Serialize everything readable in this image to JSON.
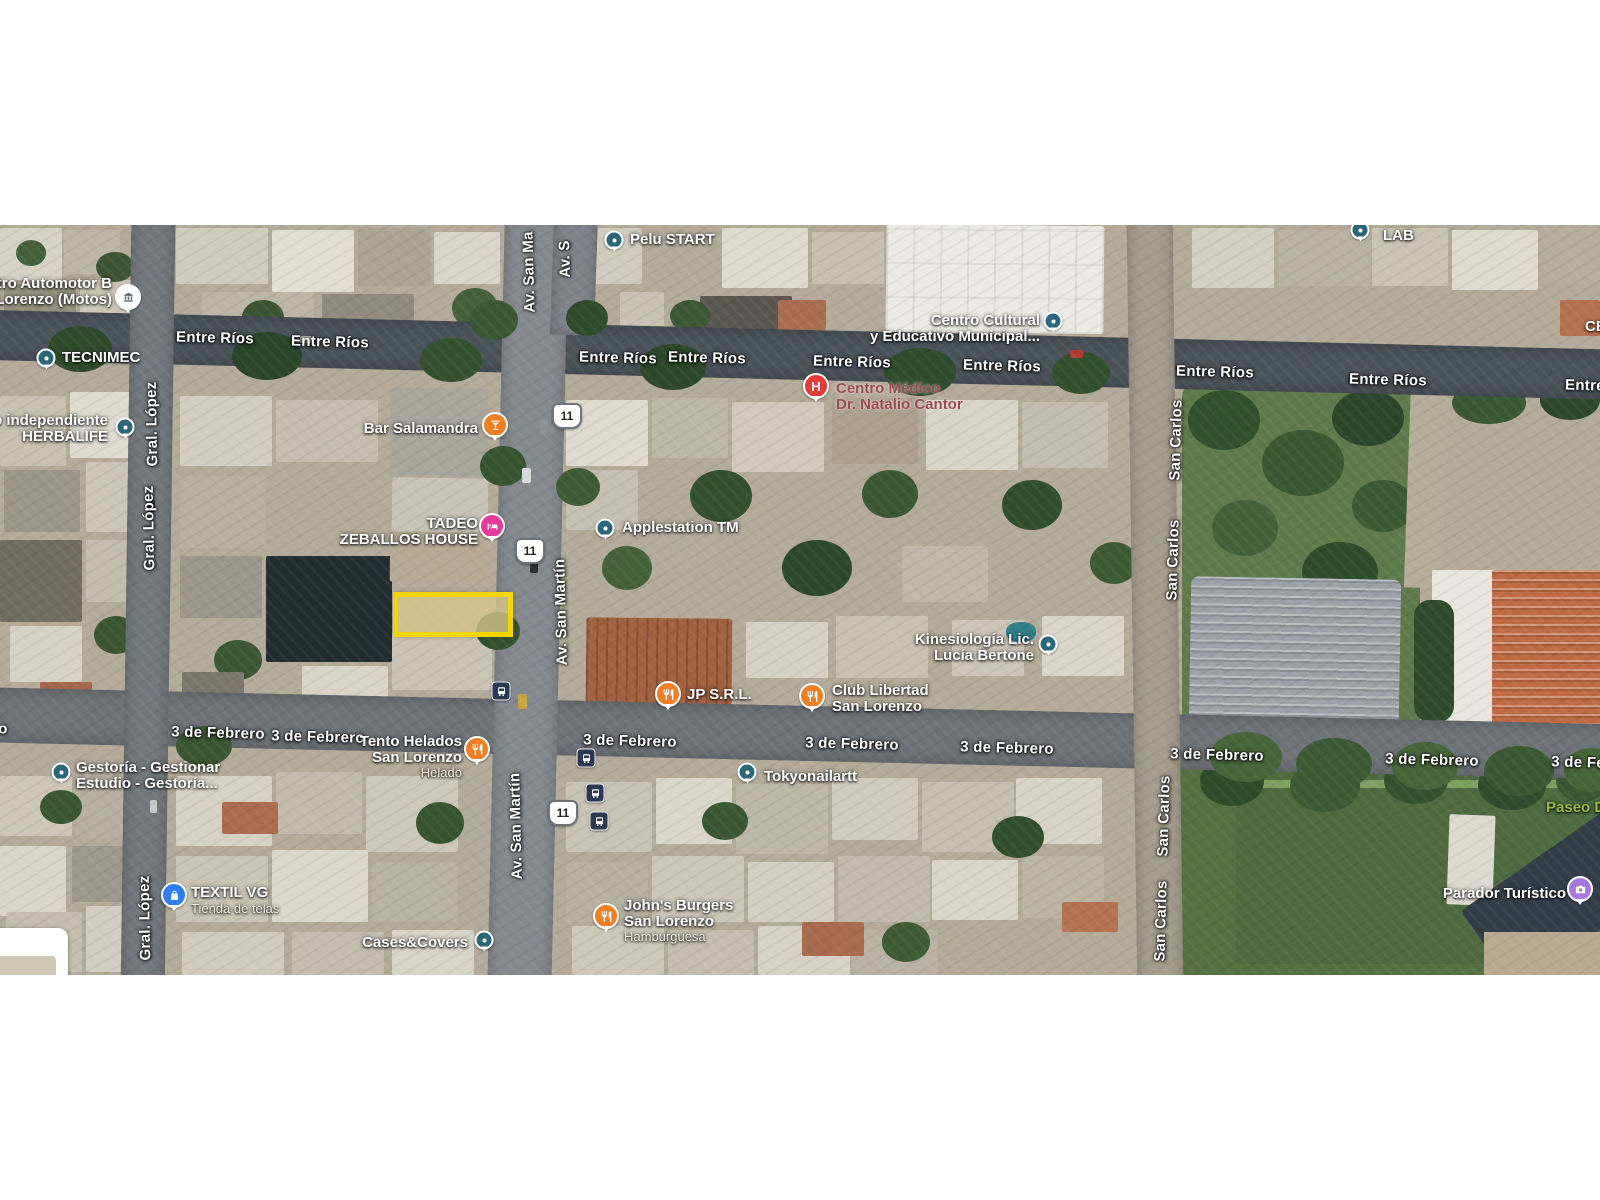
{
  "map": {
    "highlight": {
      "x": 393,
      "y": 592,
      "w": 110,
      "h": 35,
      "border_color": "#F6D400",
      "fill_color": "rgba(216,198,140,0.78)"
    },
    "colors": {
      "generic_marker": "#2A6879",
      "restaurant_marker": "#F07E22",
      "lodging_marker": "#E5399B",
      "hospital_marker": "#E53935",
      "shopping_marker": "#2F7DF6",
      "photo_marker": "#A678DD",
      "transit_bg": "#2B3A52",
      "health_text": "#9B4A50",
      "park_text": "#9DB64C",
      "highlight": "#F6D400"
    },
    "street_labels": [
      {
        "text": "Entre Ríos",
        "x": 215,
        "y": 338,
        "rot": 1.5
      },
      {
        "text": "Entre Ríos",
        "x": 330,
        "y": 342,
        "rot": 1.5
      },
      {
        "text": "Entre Ríos",
        "x": 618,
        "y": 358,
        "rot": 1.5
      },
      {
        "text": "Entre Ríos",
        "x": 707,
        "y": 358,
        "rot": 1.5
      },
      {
        "text": "Entre Ríos",
        "x": 852,
        "y": 362,
        "rot": 1.5
      },
      {
        "text": "Entre Ríos",
        "x": 1002,
        "y": 366,
        "rot": 1.5
      },
      {
        "text": "Entre Ríos",
        "x": 1215,
        "y": 372,
        "rot": 1.5
      },
      {
        "text": "Entre Ríos",
        "x": 1388,
        "y": 380,
        "rot": 1.5
      },
      {
        "text": "Entre Ríos",
        "x": 1604,
        "y": 386,
        "rot": 1.5
      },
      {
        "text": "3 de Febrero",
        "x": 218,
        "y": 733,
        "rot": 1.5
      },
      {
        "text": "3 de Febrero",
        "x": 318,
        "y": 737,
        "rot": 1.5
      },
      {
        "text": "3 de Febrero",
        "x": 630,
        "y": 741,
        "rot": 1.5
      },
      {
        "text": "3 de Febrero",
        "x": 852,
        "y": 744,
        "rot": 1.5
      },
      {
        "text": "3 de Febrero",
        "x": 1007,
        "y": 748,
        "rot": 1.5
      },
      {
        "text": "3 de Febrero",
        "x": 1217,
        "y": 755,
        "rot": 1.5
      },
      {
        "text": "3 de Febrero",
        "x": 1432,
        "y": 760,
        "rot": 1.5
      },
      {
        "text": "3 de Febrero",
        "x": 1598,
        "y": 763,
        "rot": 1.5
      },
      {
        "text": "o",
        "x": 3,
        "y": 729,
        "rot": 0
      },
      {
        "text": "Gral. López",
        "x": 152,
        "y": 424,
        "rot": -91
      },
      {
        "text": "Gral. López",
        "x": 149,
        "y": 528,
        "rot": -91
      },
      {
        "text": "Gral. López",
        "x": 145,
        "y": 918,
        "rot": -91
      },
      {
        "text": "Av. San Ma",
        "x": 529,
        "y": 272,
        "rot": -91.5
      },
      {
        "text": "Av. S",
        "x": 565,
        "y": 259,
        "rot": -91.5
      },
      {
        "text": "Av. San Martín",
        "x": 561,
        "y": 612,
        "rot": -91.5
      },
      {
        "text": "Av. San Martín",
        "x": 516,
        "y": 826,
        "rot": -91.5
      },
      {
        "text": "San Carlos",
        "x": 1176,
        "y": 440,
        "rot": -88.5
      },
      {
        "text": "San Carlos",
        "x": 1173,
        "y": 560,
        "rot": -88.5
      },
      {
        "text": "San Carlos",
        "x": 1164,
        "y": 816,
        "rot": -88.5
      },
      {
        "text": "San Carlos",
        "x": 1161,
        "y": 921,
        "rot": -88.5
      }
    ],
    "pois": [
      {
        "name": "registro-automotor",
        "lines": [
          "gistro Automotor B",
          "n Lorenzo (Motos)"
        ],
        "x": 112,
        "y": 276,
        "align": "right",
        "marker": {
          "kind": "museum",
          "x": 128,
          "y": 297
        }
      },
      {
        "name": "tecnimec",
        "lines": [
          "TECNIMEC"
        ],
        "x": 62,
        "y": 350,
        "align": "left",
        "marker": {
          "kind": "generic",
          "x": 46,
          "y": 358
        }
      },
      {
        "name": "herbalife",
        "lines": [
          "ado independiente",
          "HERBALIFE"
        ],
        "x": 108,
        "y": 413,
        "align": "right",
        "marker": {
          "kind": "generic",
          "x": 125,
          "y": 427
        }
      },
      {
        "name": "pelu-start",
        "lines": [
          "Pelu START"
        ],
        "x": 630,
        "y": 232,
        "align": "left",
        "marker": {
          "kind": "generic",
          "x": 614,
          "y": 240
        }
      },
      {
        "name": "bar-salamandra",
        "lines": [
          "Bar Salamandra"
        ],
        "x": 478,
        "y": 421,
        "align": "right",
        "marker": {
          "kind": "bar",
          "x": 495,
          "y": 425
        }
      },
      {
        "name": "tadeo-zeballos-house",
        "lines": [
          "TADEO",
          "ZEBALLOS HOUSE"
        ],
        "x": 478,
        "y": 516,
        "align": "right",
        "marker": {
          "kind": "lodging",
          "x": 492,
          "y": 526
        }
      },
      {
        "name": "applestation",
        "lines": [
          "Applestation TM"
        ],
        "x": 622,
        "y": 520,
        "align": "left",
        "marker": {
          "kind": "generic",
          "x": 605,
          "y": 528
        }
      },
      {
        "name": "centro-cultural",
        "lines": [
          "Centro Cultural",
          "y Educativo Municipal..."
        ],
        "x": 1040,
        "y": 313,
        "align": "right",
        "marker": {
          "kind": "generic",
          "x": 1053,
          "y": 321
        }
      },
      {
        "name": "centro-medico",
        "lines": [
          "Centro Médico",
          "Dr. Natalio Cantor"
        ],
        "x": 836,
        "y": 381,
        "align": "left",
        "color": "#9B4A50",
        "halo": "light",
        "marker": {
          "kind": "hospital",
          "x": 816,
          "y": 386
        }
      },
      {
        "name": "kinesiologia",
        "lines": [
          "Kinesiología Lic.",
          "Lucía Bertone"
        ],
        "x": 1034,
        "y": 632,
        "align": "right",
        "marker": {
          "kind": "generic",
          "x": 1048,
          "y": 644
        }
      },
      {
        "name": "jp-srl",
        "lines": [
          "JP S.R.L."
        ],
        "x": 687,
        "y": 687,
        "align": "left",
        "marker": {
          "kind": "restaurant",
          "x": 668,
          "y": 694
        }
      },
      {
        "name": "club-libertad",
        "lines": [
          "Club Libertad",
          "San Lorenzo"
        ],
        "x": 832,
        "y": 683,
        "align": "left",
        "marker": {
          "kind": "restaurant",
          "x": 812,
          "y": 696
        }
      },
      {
        "name": "tento-helados",
        "lines": [
          "Tento Helados",
          "San Lorenzo"
        ],
        "sub": "Helado",
        "x": 462,
        "y": 734,
        "align": "right",
        "marker": {
          "kind": "restaurant",
          "x": 477,
          "y": 749
        }
      },
      {
        "name": "gestoria",
        "lines": [
          "Gestoría - Gestionar",
          "Estudio - Gestoría..."
        ],
        "x": 76,
        "y": 760,
        "align": "left",
        "marker": {
          "kind": "generic",
          "x": 61,
          "y": 772
        }
      },
      {
        "name": "tokyonailartt",
        "lines": [
          "Tokyonailartt"
        ],
        "x": 764,
        "y": 769,
        "align": "left",
        "marker": {
          "kind": "generic",
          "x": 747,
          "y": 772
        }
      },
      {
        "name": "textil-vg",
        "lines": [
          "TEXTIL VG"
        ],
        "sub": "Tienda de telas",
        "x": 191,
        "y": 885,
        "align": "left",
        "marker": {
          "kind": "shopping",
          "x": 174,
          "y": 895
        }
      },
      {
        "name": "cases-covers",
        "lines": [
          "Cases&Covers"
        ],
        "x": 468,
        "y": 935,
        "align": "right",
        "marker": {
          "kind": "generic",
          "x": 484,
          "y": 940
        }
      },
      {
        "name": "johns-burgers",
        "lines": [
          "John's Burgers",
          "San Lorenzo"
        ],
        "sub": "Hamburguesa",
        "x": 624,
        "y": 898,
        "align": "left",
        "marker": {
          "kind": "restaurant",
          "x": 606,
          "y": 916
        }
      },
      {
        "name": "parador-turistico",
        "lines": [
          "Parador Turístico"
        ],
        "x": 1566,
        "y": 886,
        "align": "right",
        "marker": {
          "kind": "photo",
          "x": 1580,
          "y": 889
        }
      },
      {
        "name": "paseo",
        "lines": [
          "Paseo De"
        ],
        "x": 1546,
        "y": 800,
        "align": "left",
        "color": "#9DB64C"
      },
      {
        "name": "lab",
        "lines": [
          "LAB"
        ],
        "x": 1383,
        "y": 228,
        "align": "left",
        "marker": {
          "kind": "generic",
          "x": 1360,
          "y": 230
        }
      },
      {
        "name": "ce-partial",
        "lines": [
          "CE"
        ],
        "x": 1585,
        "y": 319,
        "align": "left"
      }
    ],
    "route_shields": [
      {
        "text": "11",
        "x": 567,
        "y": 416
      },
      {
        "text": "11",
        "x": 530,
        "y": 551
      },
      {
        "text": "11",
        "x": 563,
        "y": 813
      }
    ],
    "transit_stops": [
      {
        "x": 501,
        "y": 691
      },
      {
        "x": 586,
        "y": 758
      },
      {
        "x": 595,
        "y": 793
      },
      {
        "x": 599,
        "y": 821
      }
    ]
  }
}
